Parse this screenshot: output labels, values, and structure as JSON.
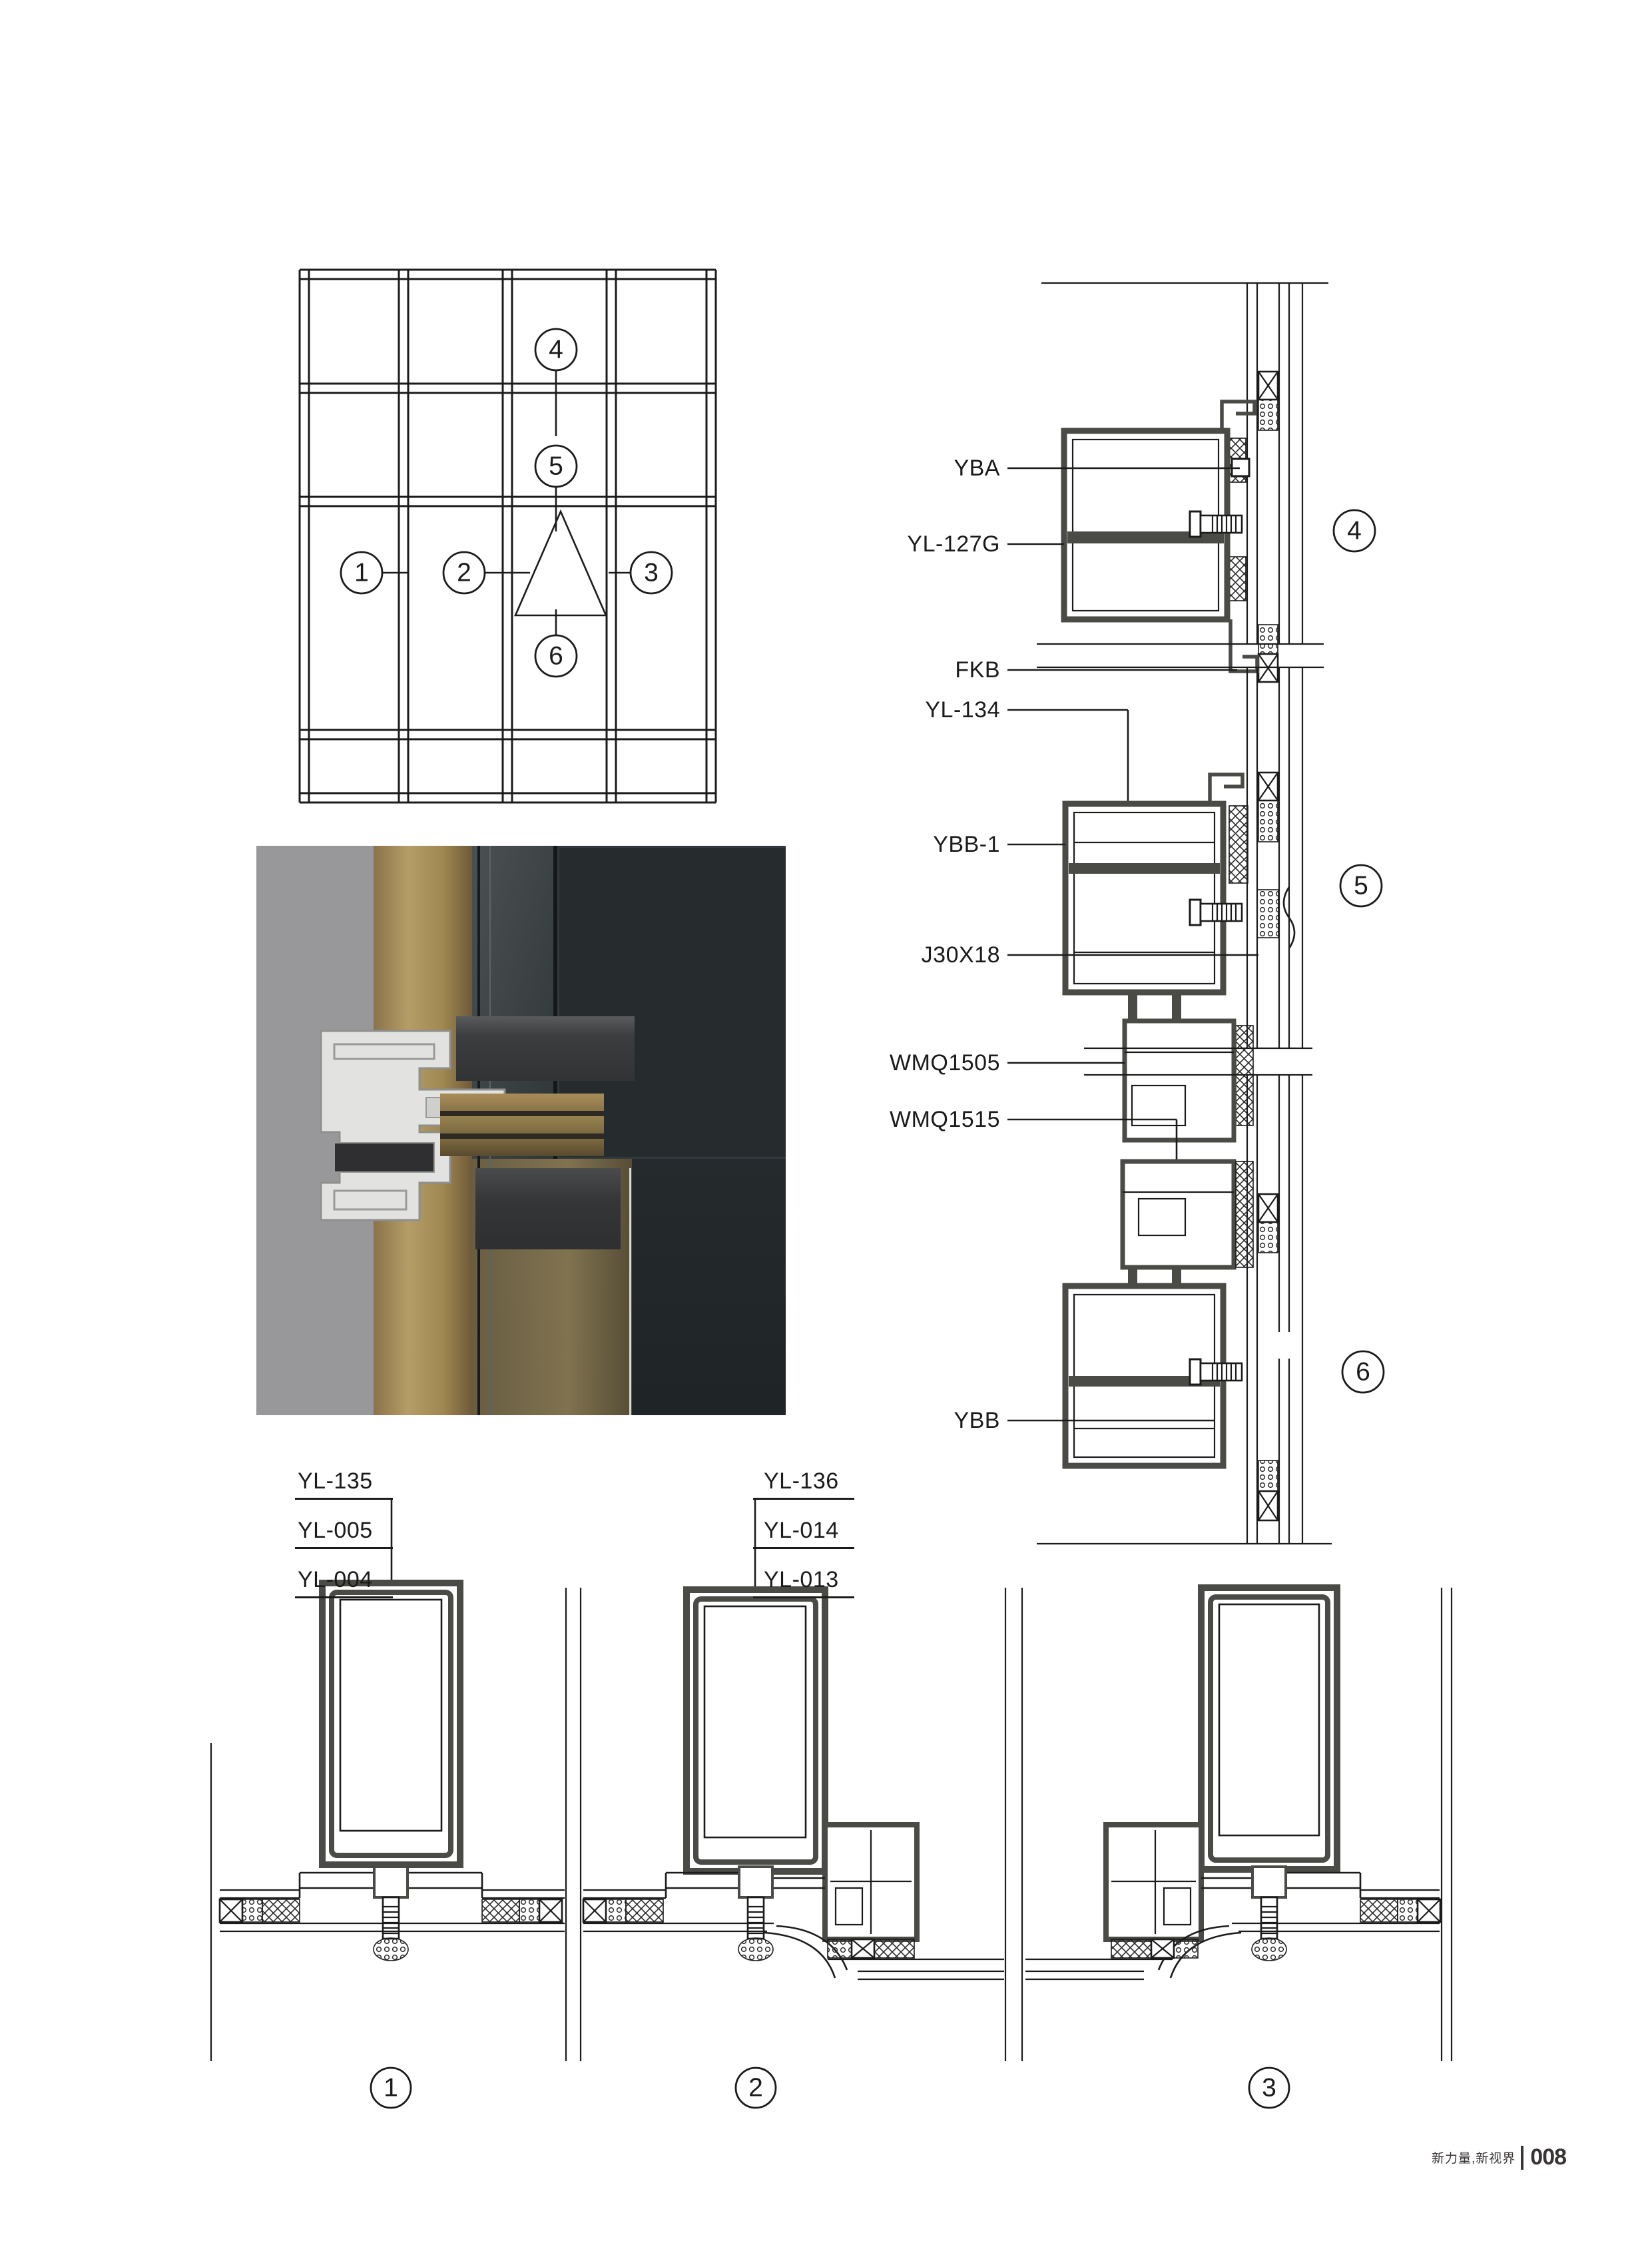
{
  "footer": {
    "slogan": "新力量,新视界",
    "page_number": "008"
  },
  "elevation": {
    "callouts": [
      "1",
      "2",
      "3",
      "4",
      "5",
      "6"
    ]
  },
  "sections": {
    "s4": {
      "number": "4",
      "labels": [
        "YBA",
        "YL-127G",
        "FKB"
      ]
    },
    "s5": {
      "number": "5",
      "labels": [
        "YL-134",
        "YBB-1",
        "J30X18",
        "WMQ1505"
      ]
    },
    "s6": {
      "number": "6",
      "labels": [
        "WMQ1515",
        "YBB"
      ]
    }
  },
  "details": {
    "stack1": [
      "YL-135",
      "YL-005",
      "YL-004"
    ],
    "stack2": [
      "YL-136",
      "YL-014",
      "YL-013"
    ],
    "numbers": [
      "1",
      "2",
      "3"
    ]
  },
  "colors": {
    "line": "#1b1b1b",
    "profile": "#4a4a46",
    "footer_text": "#3a3535",
    "render_background": "#98989a",
    "render_gold": "#a08852",
    "render_glass": "#23282a",
    "render_aluminum": "#e2e2e0"
  }
}
